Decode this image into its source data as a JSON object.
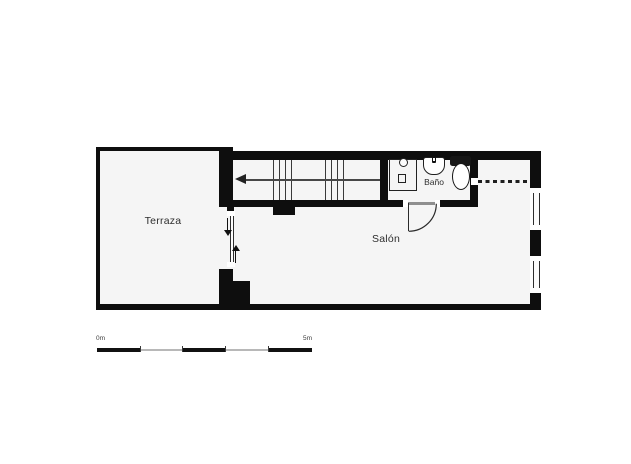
{
  "plan": {
    "type": "floorplan",
    "rooms": {
      "terraza": {
        "label": "Terraza"
      },
      "salon": {
        "label": "Salón"
      },
      "bano": {
        "label": "Baño"
      }
    },
    "stairs": {
      "direction_arrow": "left",
      "tread_groups": 2,
      "treads_per_group": 4
    },
    "doors": [
      {
        "name": "sliding-door-terraza-salon",
        "style": "glazed, opposing arrows"
      },
      {
        "name": "bano-door",
        "swing": "down-right into salon"
      }
    ],
    "windows": {
      "right_wall_segments": 2,
      "dashed_opening_top_right": true
    },
    "fixtures": [
      {
        "icon": "shower-tray-icon"
      },
      {
        "icon": "washbasin-icon"
      },
      {
        "icon": "toilet-icon"
      }
    ],
    "scale_bar": {
      "start_label": "0m",
      "end_label": "5m",
      "segments": 5
    }
  },
  "colors": {
    "wall": "#0e0e0e",
    "floor": "#f5f5f5",
    "background": "#ffffff",
    "text": "#2e2e2e",
    "line": "#3a3a3a",
    "scale_gray": "#b8b8b8"
  }
}
